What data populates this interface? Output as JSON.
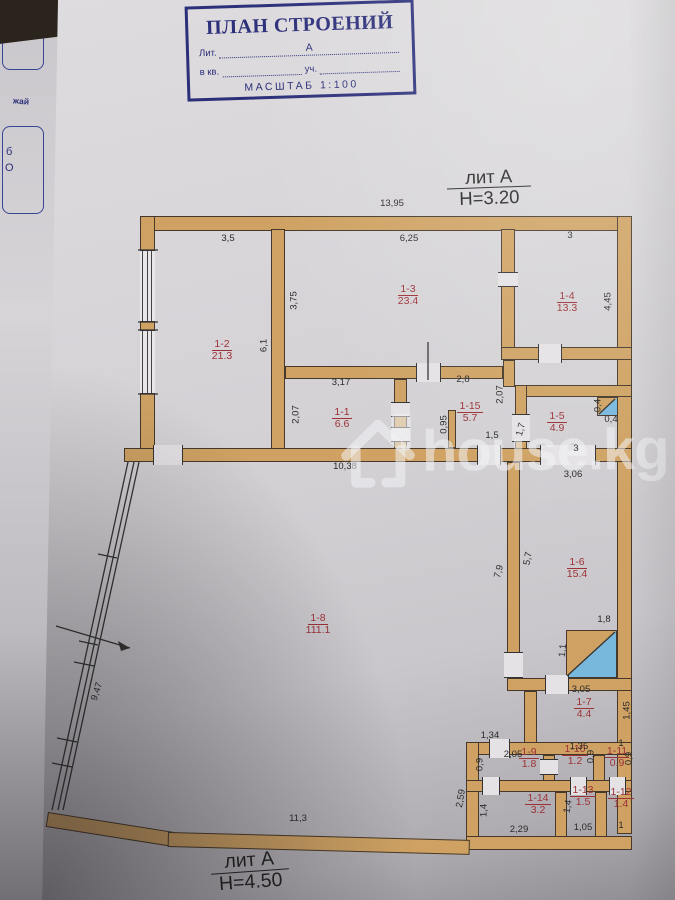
{
  "colors": {
    "wall": "#cfa263",
    "wallline": "#46392b",
    "blue": "#79b8dd",
    "red": "#9c3136",
    "ink": "#2a2a2a",
    "navy": "#2c2f7a"
  },
  "document": {
    "title_block": {
      "title": "ПЛАН СТРОЕНИЙ",
      "lit_label": "Лит.",
      "lit_value": "А",
      "kv_label": "в кв.",
      "uch_label": "уч.",
      "scale_label": "МАСШТАБ 1:100"
    },
    "floor_marks": {
      "top": {
        "lit": "лит А",
        "height": "H=3.20"
      },
      "bottom": {
        "lit": "лит А",
        "height": "H=4.50"
      }
    },
    "watermark_text": "house.kg",
    "side_page_fragments": {
      "text1": "жай",
      "text2": "б",
      "text3": "О"
    }
  },
  "plan": {
    "rooms": [
      {
        "id": "1-2",
        "area": "21.3",
        "x": 222,
        "y": 338
      },
      {
        "id": "1-3",
        "area": "23.4",
        "x": 408,
        "y": 283
      },
      {
        "id": "1-4",
        "area": "13.3",
        "x": 567,
        "y": 290
      },
      {
        "id": "1-1",
        "area": "6.6",
        "x": 342,
        "y": 406
      },
      {
        "id": "1-15",
        "area": "5.7",
        "x": 470,
        "y": 400
      },
      {
        "id": "1-5",
        "area": "4.9",
        "x": 557,
        "y": 410
      },
      {
        "id": "1-6",
        "area": "15.4",
        "x": 577,
        "y": 556
      },
      {
        "id": "1-8",
        "area": "111.1",
        "x": 318,
        "y": 612
      },
      {
        "id": "1-7",
        "area": "4.4",
        "x": 584,
        "y": 696
      },
      {
        "id": "1-9",
        "area": "1.8",
        "x": 529,
        "y": 746
      },
      {
        "id": "1-10",
        "area": "1.2",
        "x": 575,
        "y": 743
      },
      {
        "id": "1-11",
        "area": "0.9",
        "x": 617,
        "y": 745
      },
      {
        "id": "1-14",
        "area": "3.2",
        "x": 538,
        "y": 792
      },
      {
        "id": "1-13",
        "area": "1.5",
        "x": 583,
        "y": 784
      },
      {
        "id": "1-12",
        "area": "1.4",
        "x": 621,
        "y": 786
      }
    ],
    "dims": [
      {
        "t": "13,95",
        "x": 392,
        "y": 204,
        "r": 0
      },
      {
        "t": "3,5",
        "x": 228,
        "y": 239,
        "r": 0
      },
      {
        "t": "6,25",
        "x": 409,
        "y": 239,
        "r": 0
      },
      {
        "t": "3",
        "x": 570,
        "y": 236,
        "r": 0
      },
      {
        "t": "3,75",
        "x": 294,
        "y": 301,
        "r": -90
      },
      {
        "t": "6,1",
        "x": 264,
        "y": 346,
        "r": -90
      },
      {
        "t": "4,45",
        "x": 608,
        "y": 302,
        "r": -90
      },
      {
        "t": "2,07",
        "x": 296,
        "y": 415,
        "r": -90
      },
      {
        "t": "3,17",
        "x": 341,
        "y": 383,
        "r": 0
      },
      {
        "t": "2,8",
        "x": 463,
        "y": 380,
        "r": 0
      },
      {
        "t": "2,07",
        "x": 500,
        "y": 395,
        "r": -90
      },
      {
        "t": "0,95",
        "x": 444,
        "y": 425,
        "r": -90
      },
      {
        "t": "1,5",
        "x": 492,
        "y": 436,
        "r": 0
      },
      {
        "t": "1,7",
        "x": 521,
        "y": 430,
        "r": -75
      },
      {
        "t": "0,4",
        "x": 598,
        "y": 406,
        "r": -90
      },
      {
        "t": "0,4",
        "x": 611,
        "y": 420,
        "r": 0
      },
      {
        "t": "3",
        "x": 576,
        "y": 449,
        "r": 0
      },
      {
        "t": "3,06",
        "x": 573,
        "y": 475,
        "r": 0
      },
      {
        "t": "10,38",
        "x": 345,
        "y": 467,
        "r": 0
      },
      {
        "t": "7,9",
        "x": 499,
        "y": 572,
        "r": -75
      },
      {
        "t": "5,7",
        "x": 528,
        "y": 559,
        "r": -80
      },
      {
        "t": "1,8",
        "x": 604,
        "y": 620,
        "r": 0
      },
      {
        "t": "1,1",
        "x": 563,
        "y": 651,
        "r": -85
      },
      {
        "t": "3,05",
        "x": 581,
        "y": 690,
        "r": 0
      },
      {
        "t": "1,45",
        "x": 627,
        "y": 711,
        "r": -90
      },
      {
        "t": "9,47",
        "x": 97,
        "y": 692,
        "r": -72
      },
      {
        "t": "1,34",
        "x": 490,
        "y": 736,
        "r": 0
      },
      {
        "t": "2,05",
        "x": 513,
        "y": 755,
        "r": 0
      },
      {
        "t": "0,9",
        "x": 480,
        "y": 765,
        "r": -90
      },
      {
        "t": "1,35",
        "x": 579,
        "y": 747,
        "r": 0
      },
      {
        "t": "0,9",
        "x": 591,
        "y": 757,
        "r": -90
      },
      {
        "t": "1",
        "x": 621,
        "y": 744,
        "r": 0
      },
      {
        "t": "0,9",
        "x": 629,
        "y": 759,
        "r": -90
      },
      {
        "t": "2,59",
        "x": 461,
        "y": 799,
        "r": -80
      },
      {
        "t": "1,4",
        "x": 484,
        "y": 811,
        "r": -90
      },
      {
        "t": "2,29",
        "x": 519,
        "y": 830,
        "r": 0
      },
      {
        "t": "1,4",
        "x": 568,
        "y": 807,
        "r": -80
      },
      {
        "t": "1,05",
        "x": 583,
        "y": 828,
        "r": 0
      },
      {
        "t": "1",
        "x": 621,
        "y": 826,
        "r": 0
      },
      {
        "t": "11,3",
        "x": 298,
        "y": 819,
        "r": 0
      }
    ]
  }
}
